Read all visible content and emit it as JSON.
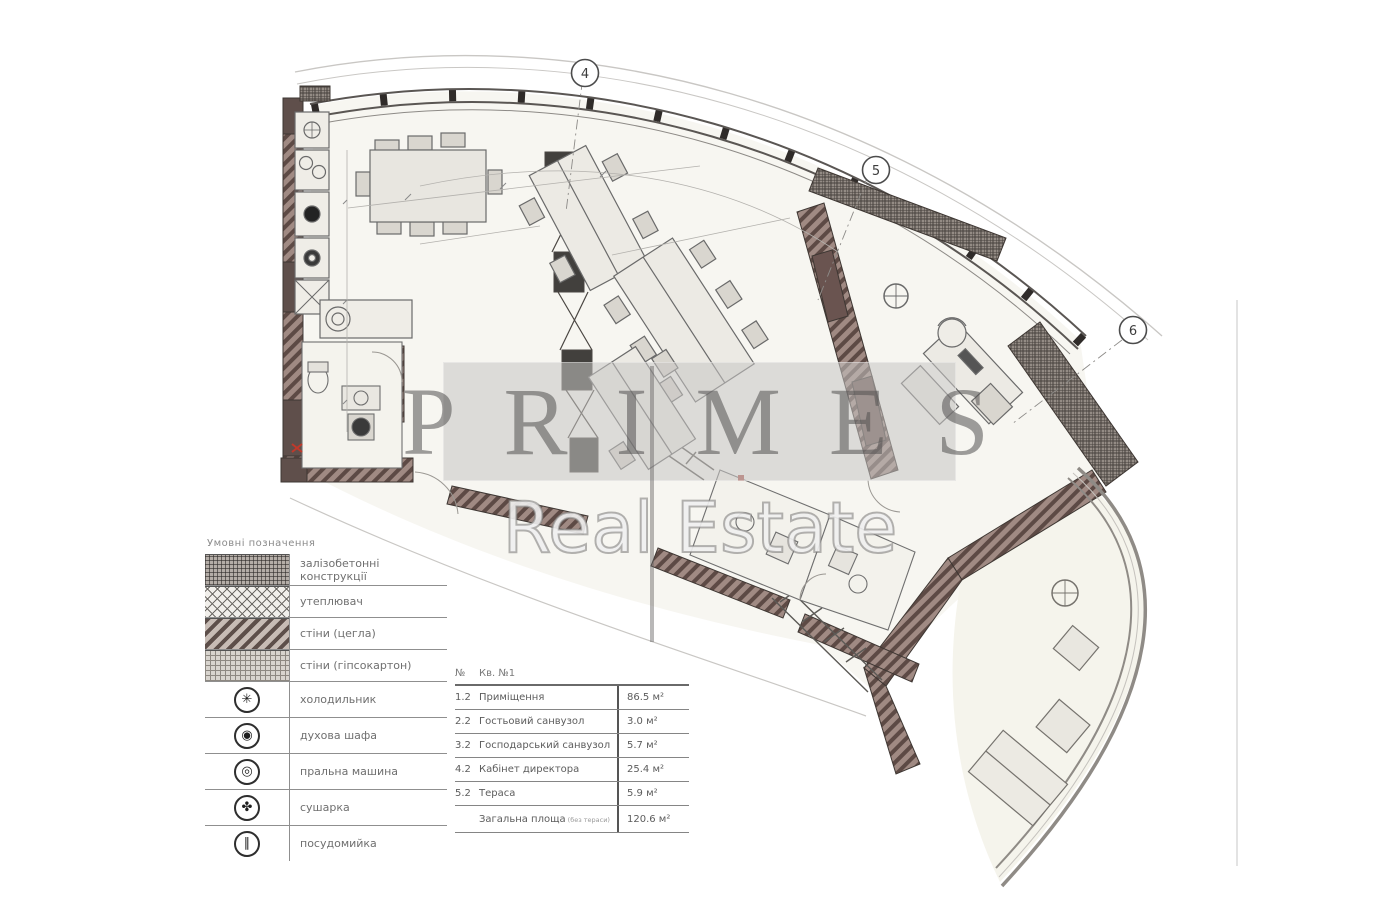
{
  "watermark": {
    "line1": "PRIMES",
    "line2": "Real Estate",
    "band_color": "#c6c4c2"
  },
  "plan": {
    "grid_markers": [
      {
        "label": "4"
      },
      {
        "label": "5"
      },
      {
        "label": "6"
      }
    ],
    "wall_accent_color": "#6a5450",
    "paper_color": "#f7f6f1"
  },
  "legend": {
    "title": "Умовні позначення",
    "hatch_items": [
      {
        "name": "reinforced-concrete",
        "label": "залізобетонні конструкції"
      },
      {
        "name": "insulation",
        "label": "утеплювач"
      },
      {
        "name": "walls-brick",
        "label": "стіни (цегла)"
      },
      {
        "name": "walls-drywall",
        "label": "стіни (гіпсокартон)"
      }
    ],
    "symbol_items": [
      {
        "name": "refrigerator",
        "glyph": "✳",
        "label": "холодильник"
      },
      {
        "name": "oven",
        "glyph": "◉",
        "label": "духова шафа"
      },
      {
        "name": "washing-machine",
        "glyph": "◎",
        "label": "пральна машина"
      },
      {
        "name": "dryer",
        "glyph": "✤",
        "label": "сушарка"
      },
      {
        "name": "dishwasher",
        "glyph": "∥",
        "label": "посудомийка"
      }
    ]
  },
  "table": {
    "col_no": "№",
    "col_name": "Кв. №1",
    "rows": [
      {
        "no": "1.2",
        "name": "Приміщення",
        "area": "86.5 м²"
      },
      {
        "no": "2.2",
        "name": "Гостьовий санвузол",
        "area": "3.0 м²"
      },
      {
        "no": "3.2",
        "name": "Господарський санвузол",
        "area": "5.7 м²"
      },
      {
        "no": "4.2",
        "name": "Кабінет директора",
        "area": "25.4 м²"
      },
      {
        "no": "5.2",
        "name": "Тераса",
        "area": "5.9 м²"
      }
    ],
    "total": {
      "label": "Загальна площа",
      "note": "(без тераси)",
      "area": "120.6 м²"
    }
  }
}
